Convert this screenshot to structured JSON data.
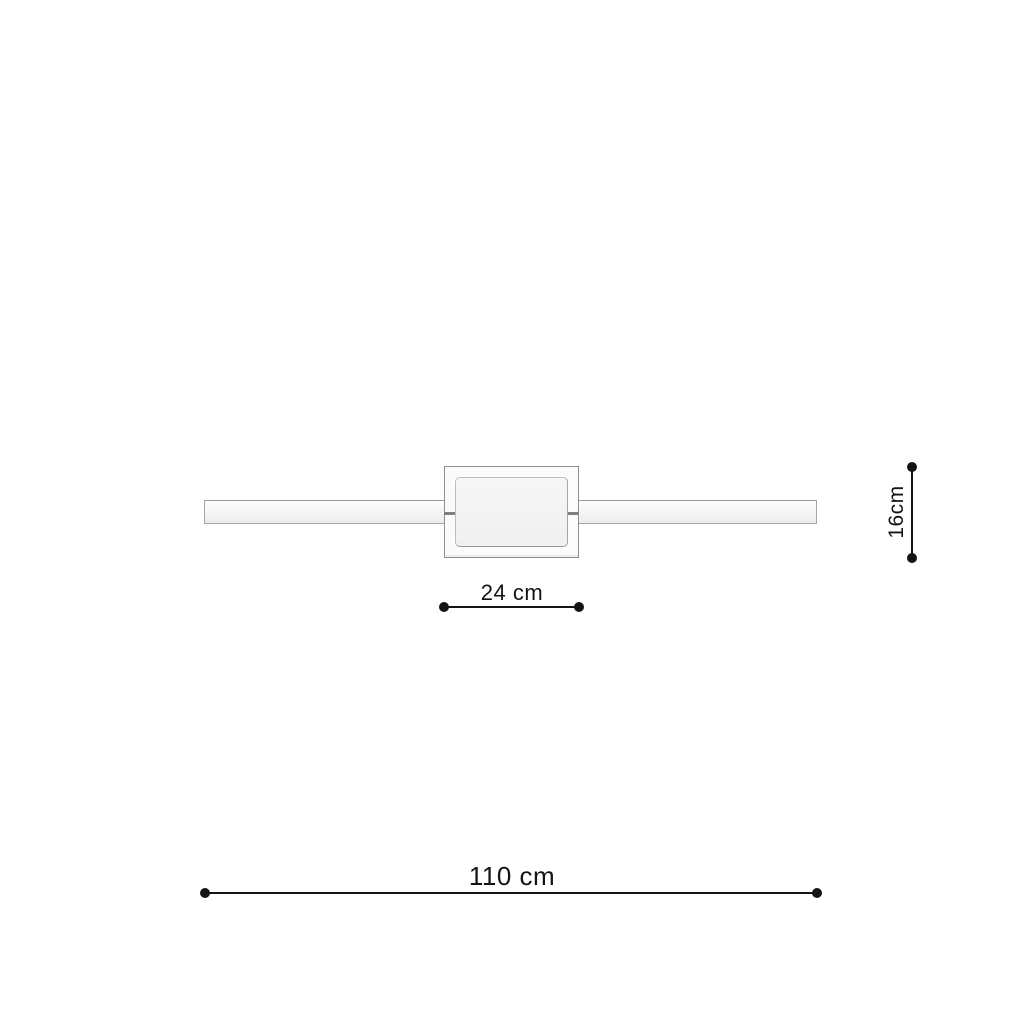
{
  "colors": {
    "background": "#ffffff",
    "line": "#141414",
    "bar_border": "#a6a6a6",
    "canopy_fill": "#fbfbfb",
    "canopy_border": "#8f8f8f",
    "panel_border": "#bdbdbd",
    "notch": "#7f7f7f"
  },
  "dimensions": {
    "canopy_width": "24 cm",
    "canopy_height": "16cm",
    "total_width": "110 cm"
  }
}
